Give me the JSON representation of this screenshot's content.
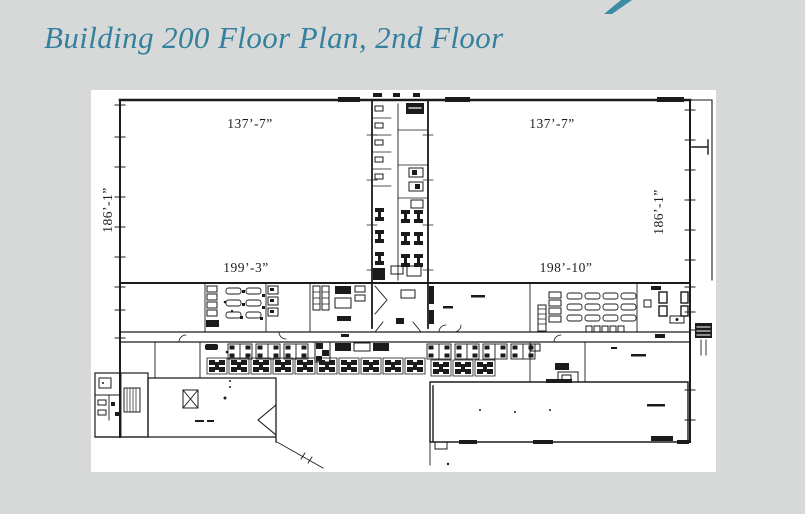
{
  "title": {
    "text": "Building 200 Floor Plan, 2nd Floor"
  },
  "colors": {
    "background": "#d7d9d9",
    "title": "#35809e",
    "swoosh": "#3a8da3",
    "ink": "#1b1b1b",
    "panel": "#ffffff"
  },
  "floor_plan": {
    "dimensions": {
      "top_left": "137’-7”",
      "top_right": "137’-7”",
      "left_side": "186’-1”",
      "right_side": "186’-1”",
      "bottom_left_span": "199’-3”",
      "bottom_right_span": "198’-10”"
    }
  }
}
